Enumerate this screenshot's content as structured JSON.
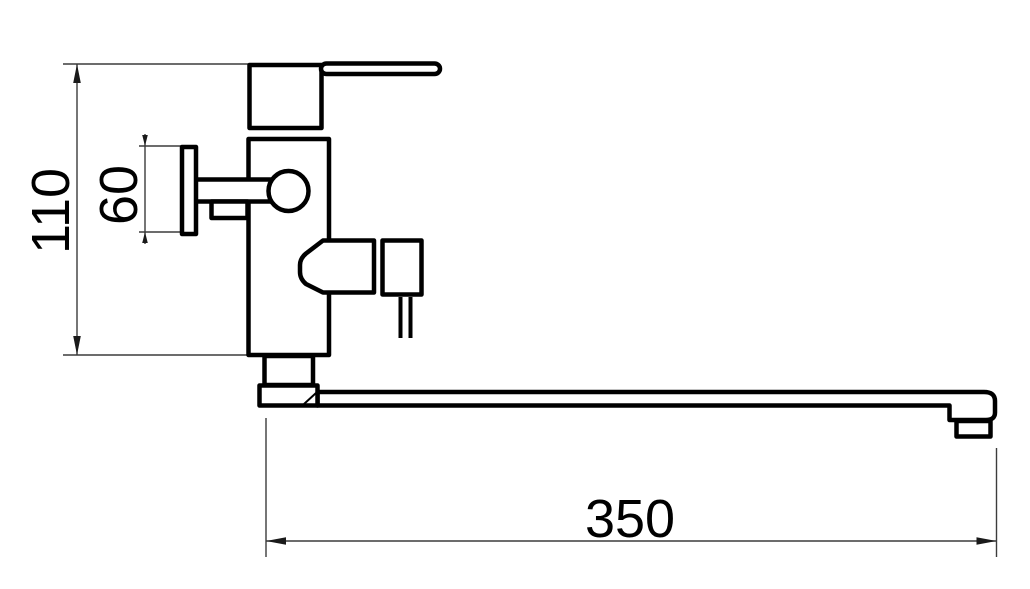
{
  "drawing": {
    "type": "technical-dimension-drawing",
    "subject": "wall-mounted single-lever bath mixer with long straight spout, side elevation",
    "background_color": "#ffffff",
    "outline_color": "#000000",
    "dimension_line_color": "#3c3c3c",
    "dimensions": {
      "overall_height": {
        "label": "110"
      },
      "wall_flange_height": {
        "label": "60"
      },
      "spout_length": {
        "label": "350"
      }
    }
  }
}
